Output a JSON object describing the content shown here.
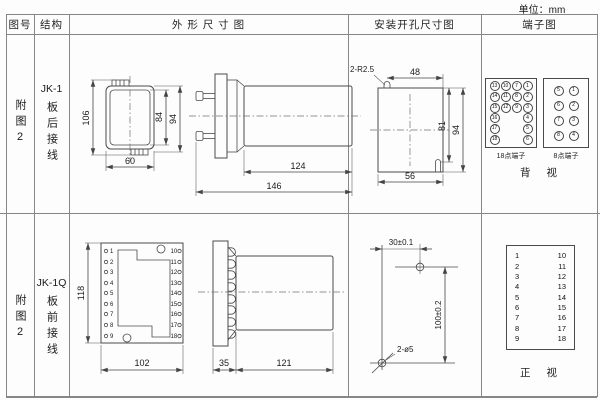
{
  "unit": "单位：mm",
  "headers": {
    "figure": "图号",
    "structure": "结构",
    "outline": "外 形 尺 寸 图",
    "install": "安装开孔尺寸图",
    "terminal": "端子图"
  },
  "row1": {
    "figure": "附图2",
    "model": "JK-1",
    "wiring": "板后接线",
    "dims": {
      "height": "106",
      "inner_height": "84",
      "outer_height": "94",
      "width": "60",
      "body_length": "124",
      "total_length": "146"
    },
    "install": {
      "slot_label": "2-R2.5",
      "top_width": "48",
      "inner_height": "81",
      "outer_height": "94",
      "bottom_width": "56"
    },
    "t18": {
      "label": "18点端子",
      "col1": [
        "13",
        "14",
        "15",
        "16",
        "17",
        "18"
      ],
      "col2": [
        "10",
        "11",
        "12"
      ],
      "col3": [
        "7",
        "8",
        "9"
      ],
      "col4": [
        "1",
        "2",
        "3",
        "4",
        "5",
        "6"
      ]
    },
    "t8": {
      "label": "8点端子",
      "left": [
        "5",
        "6",
        "7",
        "8"
      ],
      "right": [
        "1",
        "2",
        "3",
        "4"
      ]
    },
    "view_label": "背 视"
  },
  "row2": {
    "figure": "附图2",
    "model": "JK-1Q",
    "wiring": "板前接线",
    "dims": {
      "height": "118",
      "width": "102",
      "flange_depth": "35",
      "body_length": "121"
    },
    "front_terminals": {
      "left": [
        "1",
        "2",
        "3",
        "4",
        "5",
        "6",
        "7",
        "8",
        "9"
      ],
      "right": [
        "10",
        "11",
        "12",
        "13",
        "14",
        "15",
        "16",
        "17",
        "18"
      ]
    },
    "install": {
      "hole_spacing_x": "30±0.1",
      "hole_spacing_y": "100±0.2",
      "hole_label": "2-ø5"
    },
    "tbl": {
      "left": [
        "1",
        "2",
        "3",
        "4",
        "5",
        "6",
        "7",
        "8",
        "9"
      ],
      "right": [
        "10",
        "11",
        "12",
        "13",
        "14",
        "15",
        "16",
        "17",
        "18"
      ]
    },
    "view_label": "正 视"
  }
}
